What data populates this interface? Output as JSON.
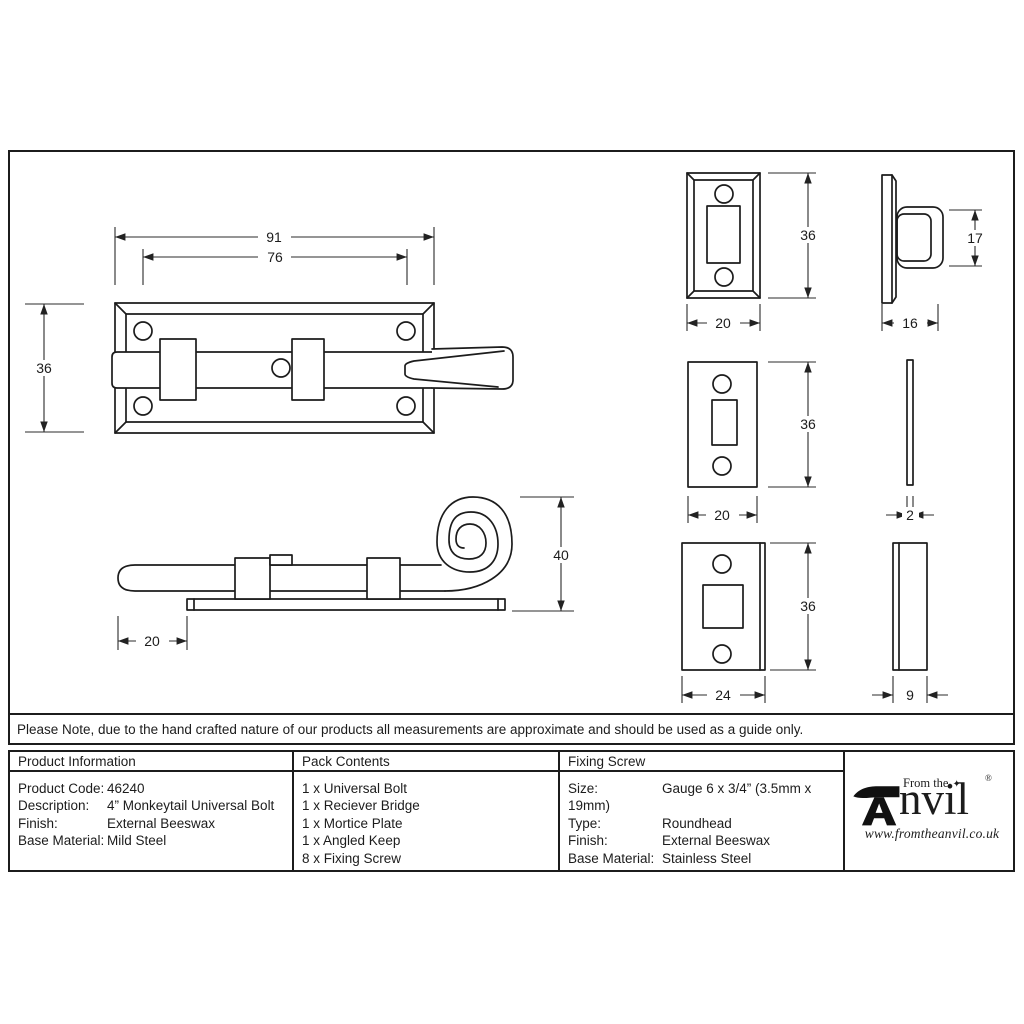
{
  "drawing": {
    "main_view": {
      "length": "91",
      "hole_spacing": "76",
      "height": "36"
    },
    "side_view": {
      "protrusion": "20",
      "curl_height": "40"
    },
    "receiver_bridge": {
      "height": "36",
      "width": "20",
      "depth": "16",
      "loop_height": "17"
    },
    "mortice_plate": {
      "height": "36",
      "width": "20",
      "thickness": "2"
    },
    "angled_keep": {
      "height": "36",
      "width": "24",
      "thickness": "9"
    }
  },
  "note": "Please Note, due to the hand crafted nature of our products all measurements are approximate and should be used as a guide only.",
  "table": {
    "product_information": {
      "title": "Product Information",
      "rows": [
        {
          "label": "Product Code:",
          "value": "46240"
        },
        {
          "label": "Description:",
          "value": "4” Monkeytail Universal Bolt"
        },
        {
          "label": "Finish:",
          "value": "External Beeswax"
        },
        {
          "label": "Base Material:",
          "value": "Mild Steel"
        }
      ]
    },
    "pack_contents": {
      "title": "Pack Contents",
      "items": [
        "1 x Universal Bolt",
        "1 x Reciever Bridge",
        "1 x Mortice Plate",
        "1 x Angled Keep",
        "8 x Fixing Screw"
      ]
    },
    "fixing_screw": {
      "title": "Fixing Screw",
      "rows": [
        {
          "label": "Size:",
          "value": "Gauge 6 x 3/4” (3.5mm x 19mm)"
        },
        {
          "label": "Type:",
          "value": "Roundhead"
        },
        {
          "label": "Finish:",
          "value": "External Beeswax"
        },
        {
          "label": "Base Material:",
          "value": "Stainless Steel"
        }
      ]
    }
  },
  "logo": {
    "prefix": "From the",
    "star": "✦",
    "name_rest": "nvil",
    "registered": "®",
    "url": "www.fromtheanvil.co.uk"
  }
}
